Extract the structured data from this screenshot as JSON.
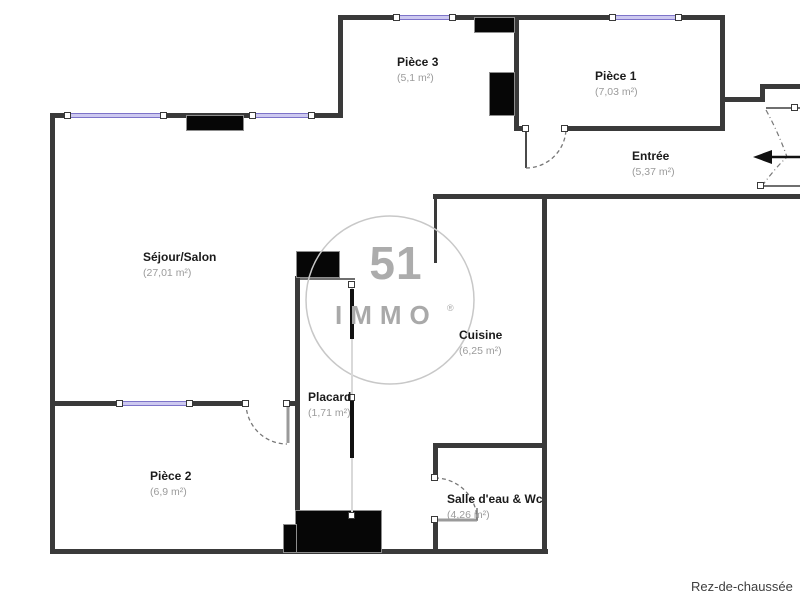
{
  "plan": {
    "floor_label": "Rez-de-chaussée",
    "rooms": [
      {
        "id": "piece3",
        "name": "Pièce 3",
        "area": "(5,1 m²)"
      },
      {
        "id": "piece1",
        "name": "Pièce 1",
        "area": "(7,03 m²)"
      },
      {
        "id": "entree",
        "name": "Entrée",
        "area": "(5,37 m²)"
      },
      {
        "id": "sejour",
        "name": "Séjour/Salon",
        "area": "(27,01 m²)"
      },
      {
        "id": "cuisine",
        "name": "Cuisine",
        "area": "(6,25 m²)"
      },
      {
        "id": "placard",
        "name": "Placard",
        "area": "(1,71 m²)"
      },
      {
        "id": "piece2",
        "name": "Pièce 2",
        "area": "(6,9 m²)"
      },
      {
        "id": "salle_eau",
        "name": "Salle d'eau & Wc",
        "area": "(4,26 m²)"
      }
    ],
    "watermark": {
      "number": "51",
      "name": "IMMO",
      "reg": "®"
    },
    "colors": {
      "wall": "#3a3a3a",
      "block": "#060606",
      "window_fill": "#cdc9f0",
      "window_border": "#7d74c9",
      "label_text": "#1b1b1b",
      "area_text": "#9b9b9b",
      "watermark": "#a9a9a9",
      "arrow": "#111111"
    }
  }
}
